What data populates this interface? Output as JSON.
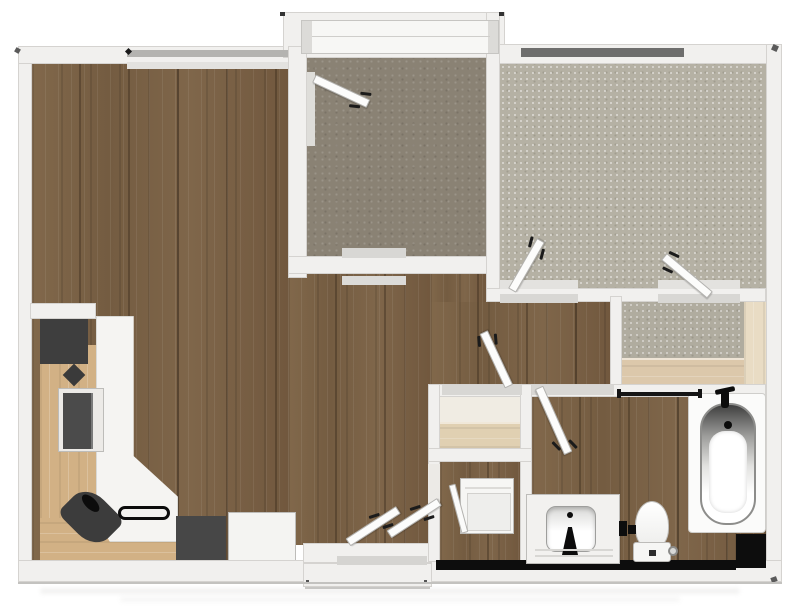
{
  "plan": {
    "type": "apartment-floor-plan",
    "rooms": [
      {
        "name": "living-dining-kitchen",
        "flooring": "dark-wood-plank"
      },
      {
        "name": "den-sunroom",
        "flooring": "taupe"
      },
      {
        "name": "bedroom",
        "flooring": "carpet"
      },
      {
        "name": "walk-in-closet",
        "flooring": "carpet-with-wood-shelving"
      },
      {
        "name": "hallway",
        "flooring": "dark-wood-plank"
      },
      {
        "name": "bathroom",
        "flooring": "dark-wood-plank"
      },
      {
        "name": "laundry-closet",
        "flooring": "dark-wood-plank"
      },
      {
        "name": "hall-closet",
        "flooring": "shelved"
      }
    ],
    "kitchen_appliances": [
      "tall-cabinet",
      "wall-oven",
      "kitchen-sink",
      "cooktop",
      "range",
      "refrigerator"
    ],
    "bathroom_fixtures": [
      "bathtub",
      "toilet",
      "sink-vanity",
      "washer-dryer",
      "floor-drain"
    ],
    "door_count": 8,
    "window_count": 3,
    "colors": {
      "wall": "#f1f0ee",
      "wood": "#7b6347",
      "den": "#8a8274",
      "carpet": "#b5b1a4",
      "tan": "#d2b185",
      "countertop": "#f5f4f2",
      "appliance": "#434343",
      "shelf": "#e0d0b2",
      "closet-shelf-low": "#dcc8ab",
      "closet-side-shelf": "#e9dcc4",
      "window-bar-dark": "#6e6e6d",
      "window-bar-light": "#b4b3b0",
      "accent-black": "#0d0d0d"
    }
  }
}
